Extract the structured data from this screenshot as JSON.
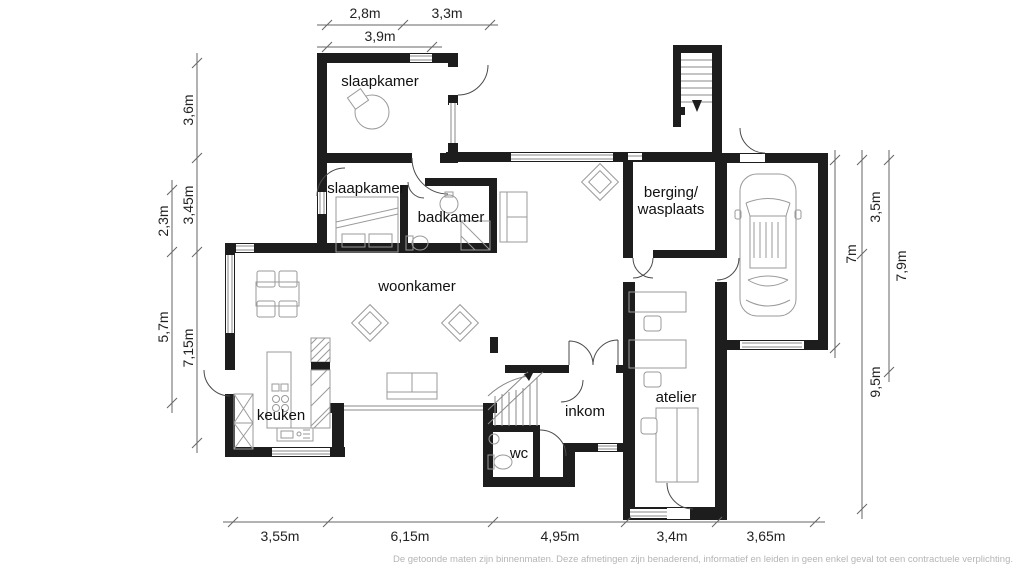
{
  "rooms": {
    "slaapkamer1": "slaapkamer",
    "slaapkamer2": "slaapkamer",
    "badkamer": "badkamer",
    "woonkamer": "woonkamer",
    "keuken": "keuken",
    "wc": "wc",
    "inkom": "inkom",
    "atelier": "atelier",
    "berging_line1": "berging/",
    "berging_line2": "wasplaats"
  },
  "dimensions": {
    "top": [
      "2,8m",
      "3,3m",
      "3,9m"
    ],
    "left": [
      "3,6m",
      "3,45m",
      "2,3m",
      "5,7m",
      "7,15m"
    ],
    "right": [
      "3,5m",
      "7m",
      "7,9m",
      "9,5m"
    ],
    "bottom": [
      "3,55m",
      "6,15m",
      "4,95m",
      "3,4m",
      "3,65m"
    ]
  },
  "disclaimer": "De getoonde maten zijn binnenmaten. Deze afmetingen zijn benaderend, informatief en leiden in geen enkel geval tot een contractuele verplichting.",
  "colors": {
    "wall": "#1d1d1d",
    "furniture_outline": "#9a9a9a",
    "dimension_line": "#666666",
    "disclaimer_text": "#b5b5b5"
  }
}
